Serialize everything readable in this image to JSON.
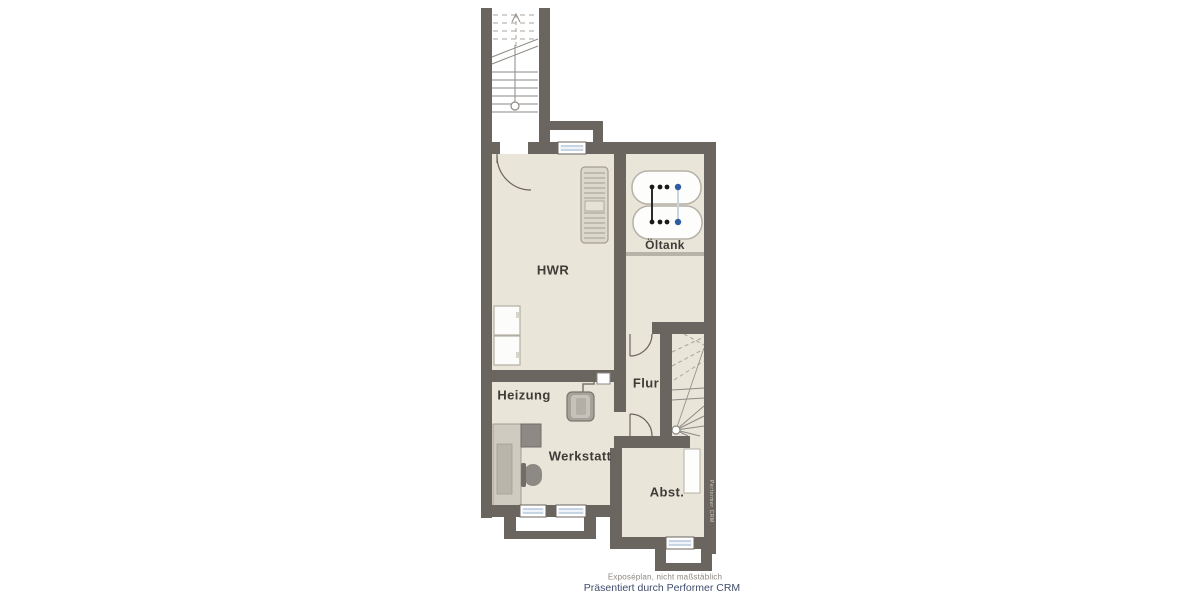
{
  "floorplan": {
    "room_labels": {
      "hwr": "HWR",
      "heizung": "Heizung",
      "werkstatt": "Werkstatt",
      "flur": "Flur",
      "oeltank": "Öltank",
      "abstellraum": "Abst."
    },
    "footer": {
      "disclaimer": "Exposéplan, nicht maßstäblich",
      "credit": "Präsentiert durch Performer CRM"
    },
    "watermark": "Performer CRM",
    "icons": {
      "oil-tanks-icon": "two oval oil tanks with gauge dots",
      "boiler-icon": "heating boiler with pipe",
      "radiator-icon": "wall radiator",
      "washer-icons": "two appliance squares",
      "workbench-icon": "L-shaped workbench with machine and chair",
      "staircase-icon": "stair treads with break line and handrail",
      "window-icon": "triple-line window symbol",
      "door-arc-icon": "door swing arc"
    },
    "colors": {
      "wall": "#6b655f",
      "floor": "#eae5d9",
      "stair_line": "#8d8984",
      "window_blue": "#9db4cf",
      "label_text": "#3e3c38",
      "disclaimer_text": "#8b8680",
      "credit_text": "#3f4d6d",
      "tank_dot_blue": "#2d5d9f"
    }
  }
}
